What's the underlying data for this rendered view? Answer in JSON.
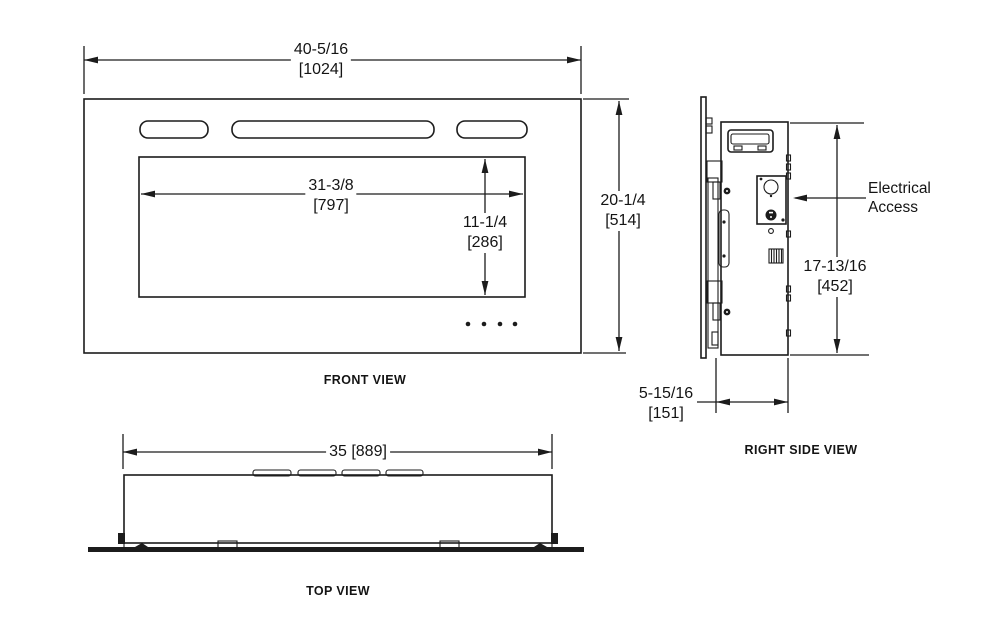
{
  "views": {
    "front": {
      "label": "FRONT VIEW",
      "overall_width": {
        "in": "40-5/16",
        "mm": "[1024]"
      },
      "overall_height": {
        "in": "20-1/4",
        "mm": "[514]"
      },
      "window_width": {
        "in": "31-3/8",
        "mm": "[797]"
      },
      "window_height": {
        "in": "11-1/4",
        "mm": "[286]"
      }
    },
    "right_side": {
      "label": "RIGHT SIDE VIEW",
      "height": {
        "in": "17-13/16",
        "mm": "[452]"
      },
      "depth": {
        "in": "5-15/16",
        "mm": "[151]"
      },
      "callout": {
        "line1": "Electrical",
        "line2": "Access"
      }
    },
    "top": {
      "label": "TOP VIEW",
      "width": "35 [889]"
    }
  },
  "colors": {
    "line": "#1c1c1c",
    "background": "#ffffff"
  }
}
